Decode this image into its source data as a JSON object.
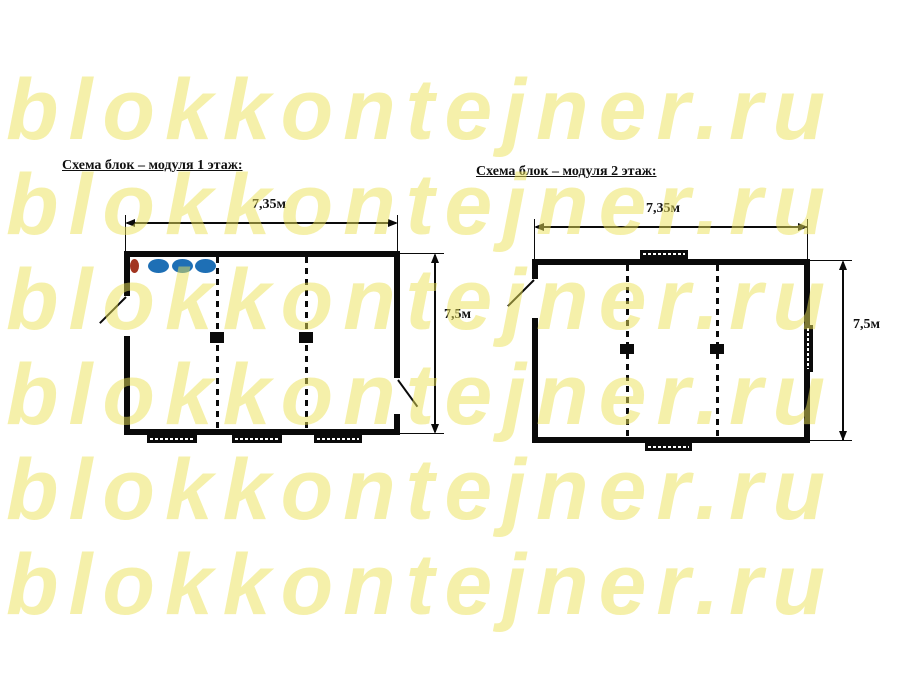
{
  "watermark": {
    "text": "blokkontejner.ru",
    "color": "#ece358",
    "opacity": 0.5,
    "rows": 6
  },
  "diagrams": [
    {
      "title": "Схема блок – модуля 1 этаж:",
      "width_label": "7,35м",
      "height_label": "7,5м",
      "rooms": 3,
      "fixtures": {
        "red": "#a23420",
        "blue": "#1e6fb5"
      }
    },
    {
      "title": "Схема блок – модуля 2 этаж:",
      "width_label": "7,35м",
      "height_label": "7,5м",
      "rooms": 3
    }
  ]
}
